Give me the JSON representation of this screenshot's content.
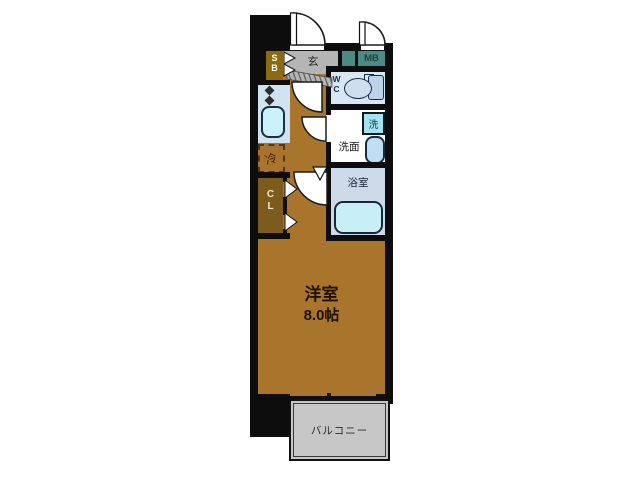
{
  "floorplan": {
    "labels": {
      "entrance": "玄",
      "shoe_box": "SB",
      "meter_box": "MB",
      "toilet": "WC",
      "washing_machine": "洗",
      "washroom": "洗面",
      "bathroom": "浴室",
      "closet": "CL",
      "refrigerator": "冷",
      "main_room": "洋室",
      "main_room_size": "8.0帖",
      "balcony": "バルコニー"
    },
    "colors": {
      "wall": "#0d0d0d",
      "room_floor": "#a9752d",
      "closet_floor": "#7d5b1d",
      "shoe_box": "#8d6a11",
      "entrance_floor": "#b5b5b5",
      "meter_box": "#4d8a85",
      "toilet_room": "#d9e6f3",
      "bathroom": "#ccdae9",
      "bathtub": "#c8eff8",
      "kitchen_counter": "#cfe3f1",
      "kitchen_sink": "#cbf2fb",
      "washing_machine_box": "#a6e3f1",
      "vanity_basin": "#c0ddf4",
      "balcony": "#c7c7c7"
    }
  }
}
